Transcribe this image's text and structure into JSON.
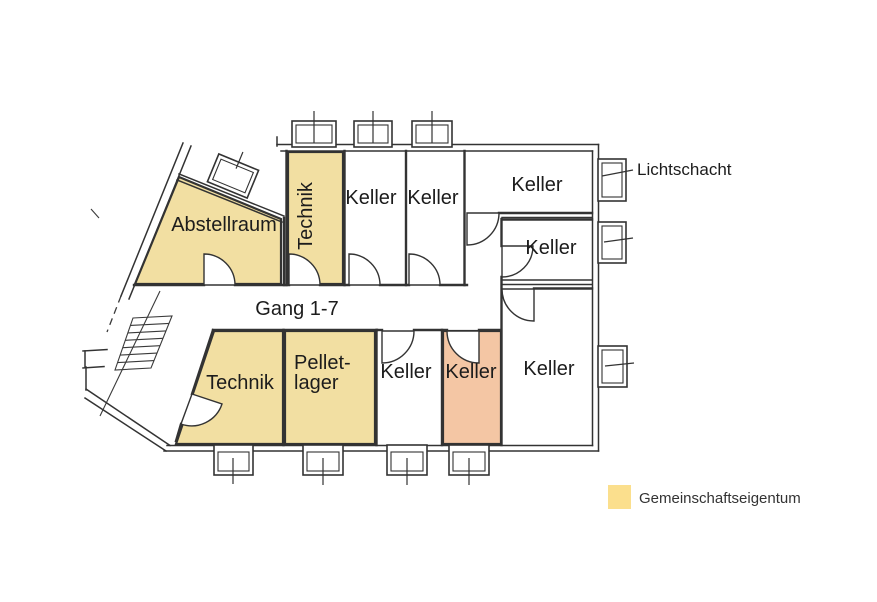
{
  "colors": {
    "common_property_fill": "#f2dfa2",
    "highlight_fill": "#f4c6a4",
    "legend_swatch": "#fbdf8d",
    "wall": "#333333",
    "label_text": "#1c1c1c"
  },
  "rooms": {
    "abstellraum": {
      "label": "Abstellraum"
    },
    "technik_top": {
      "label": "Technik"
    },
    "keller_top_1": {
      "label": "Keller"
    },
    "keller_top_2": {
      "label": "Keller"
    },
    "keller_top_right": {
      "label": "Keller"
    },
    "keller_right_2": {
      "label": "Keller"
    },
    "keller_bottom_right": {
      "label": "Keller"
    },
    "keller_bottom_white": {
      "label": "Keller"
    },
    "keller_bottom_highlight": {
      "label": "Keller"
    },
    "pelletlager": {
      "line1": "Pellet-",
      "line2": "lager"
    },
    "technik_bottom": {
      "label": "Technik"
    }
  },
  "corridor": {
    "label": "Gang 1-7"
  },
  "annotations": {
    "lichtschacht_label": "Lichtschacht"
  },
  "legend": {
    "label": "Gemeinschaftseigentum"
  }
}
